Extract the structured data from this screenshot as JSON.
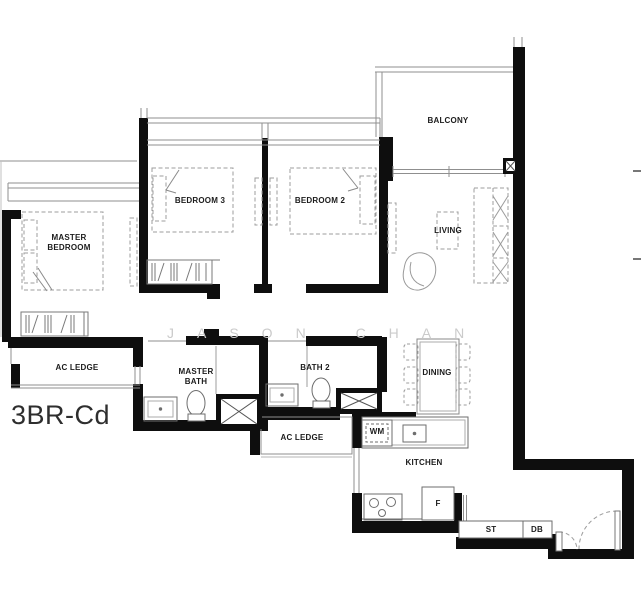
{
  "plan": {
    "unit_label": "3BR-Cd",
    "watermark": "JASON CHAN",
    "rooms": {
      "master_bedroom": {
        "line1": "MASTER",
        "line2": "BEDROOM"
      },
      "bedroom3": "BEDROOM 3",
      "bedroom2": "BEDROOM 2",
      "balcony": "BALCONY",
      "living": "LIVING",
      "dining": "DINING",
      "kitchen": "KITCHEN",
      "master_bath": {
        "line1": "MASTER",
        "line2": "BATH"
      },
      "bath2": "BATH 2",
      "ac_ledge_left": "AC LEDGE",
      "ac_ledge_right": "AC LEDGE"
    },
    "appliances": {
      "washing_machine": "WM",
      "fridge": "F",
      "storage": "ST",
      "distribution_board": "DB"
    },
    "colors": {
      "background": "#ffffff",
      "wall": "#0e0e0e",
      "thin_line": "#8f8f8f",
      "furniture_dash": "#9c9c9c",
      "label_text": "#1c1c1c",
      "watermark_text": "#cbcbcb",
      "unit_label_text": "#2e2e2e"
    }
  }
}
